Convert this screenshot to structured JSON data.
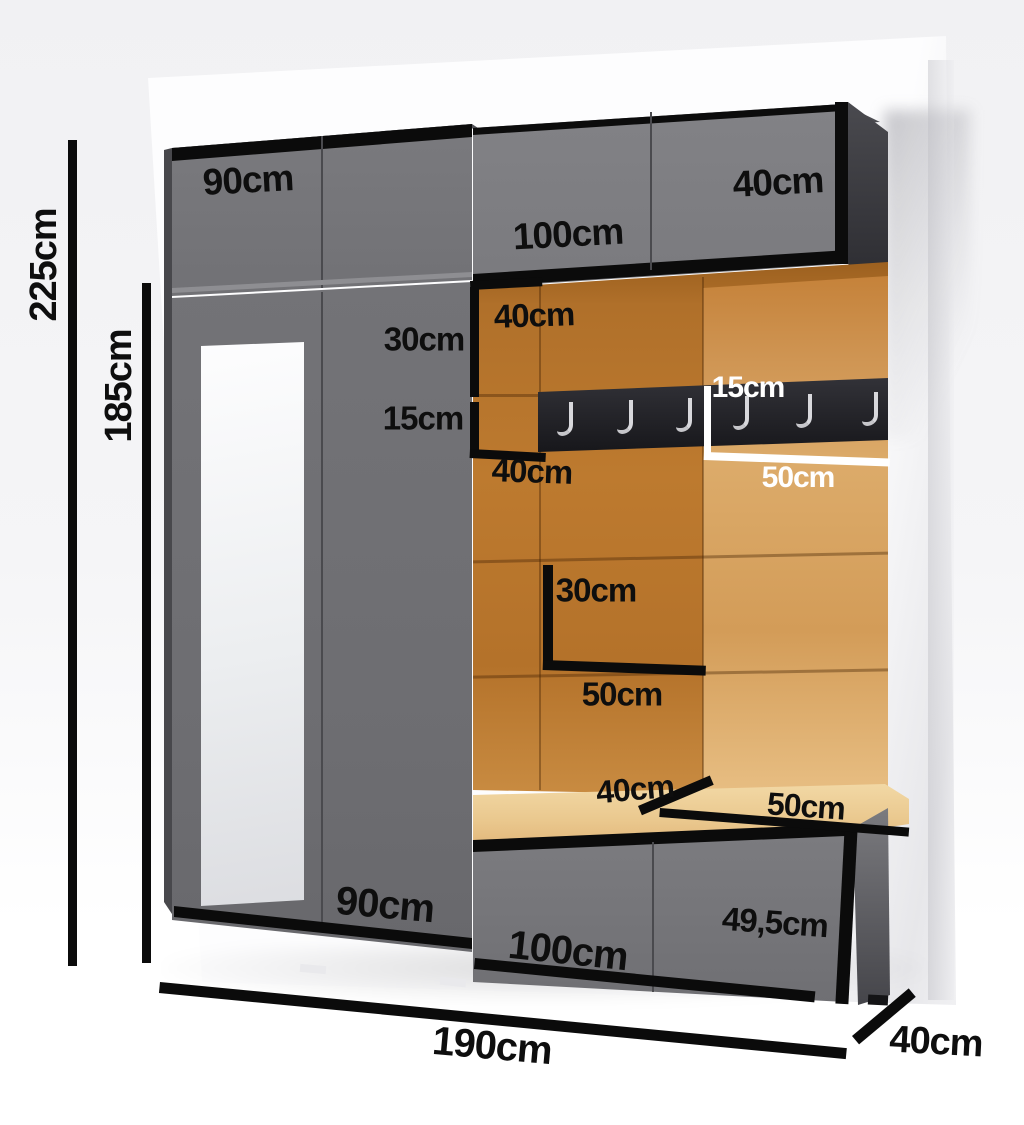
{
  "title": "Hallway furniture set dimension diagram",
  "labels": {
    "height_total": "225cm",
    "height_wardrobe": "185cm",
    "top_cabinet_left_width": "90cm",
    "top_cabinet_right_width": "100cm",
    "top_cabinet_right_door": "40cm",
    "panel_top_width": "40cm",
    "panel_top_height": "30cm",
    "panel_mid_height": "15cm",
    "panel_mid_width": "40cm",
    "hook_panel_height": "15cm",
    "hook_panel_width": "50cm",
    "panel_lower_height": "30cm",
    "panel_lower_width": "50cm",
    "bench_seat_depth": "40cm",
    "bench_seat_width": "50cm",
    "wardrobe_width": "90cm",
    "bench_cabinet_width": "100cm",
    "bench_cabinet_height": "49,5cm",
    "total_width": "190cm",
    "total_depth": "40cm"
  },
  "hooks": {
    "count": 6,
    "positions": [
      557,
      617,
      676,
      733,
      796,
      862
    ],
    "tops": [
      402,
      400,
      398,
      396,
      394,
      392
    ]
  },
  "colors": {
    "cabinet_front_gray": "#76767a",
    "cabinet_edge_black": "#0b0b0b",
    "panel_orange_dark": "#b0702a",
    "panel_orange_light": "#d9a765",
    "cushion_beige": "#ecd09b",
    "wall_white": "#fdfdfe",
    "hook_silver": "#d8d8dc"
  }
}
